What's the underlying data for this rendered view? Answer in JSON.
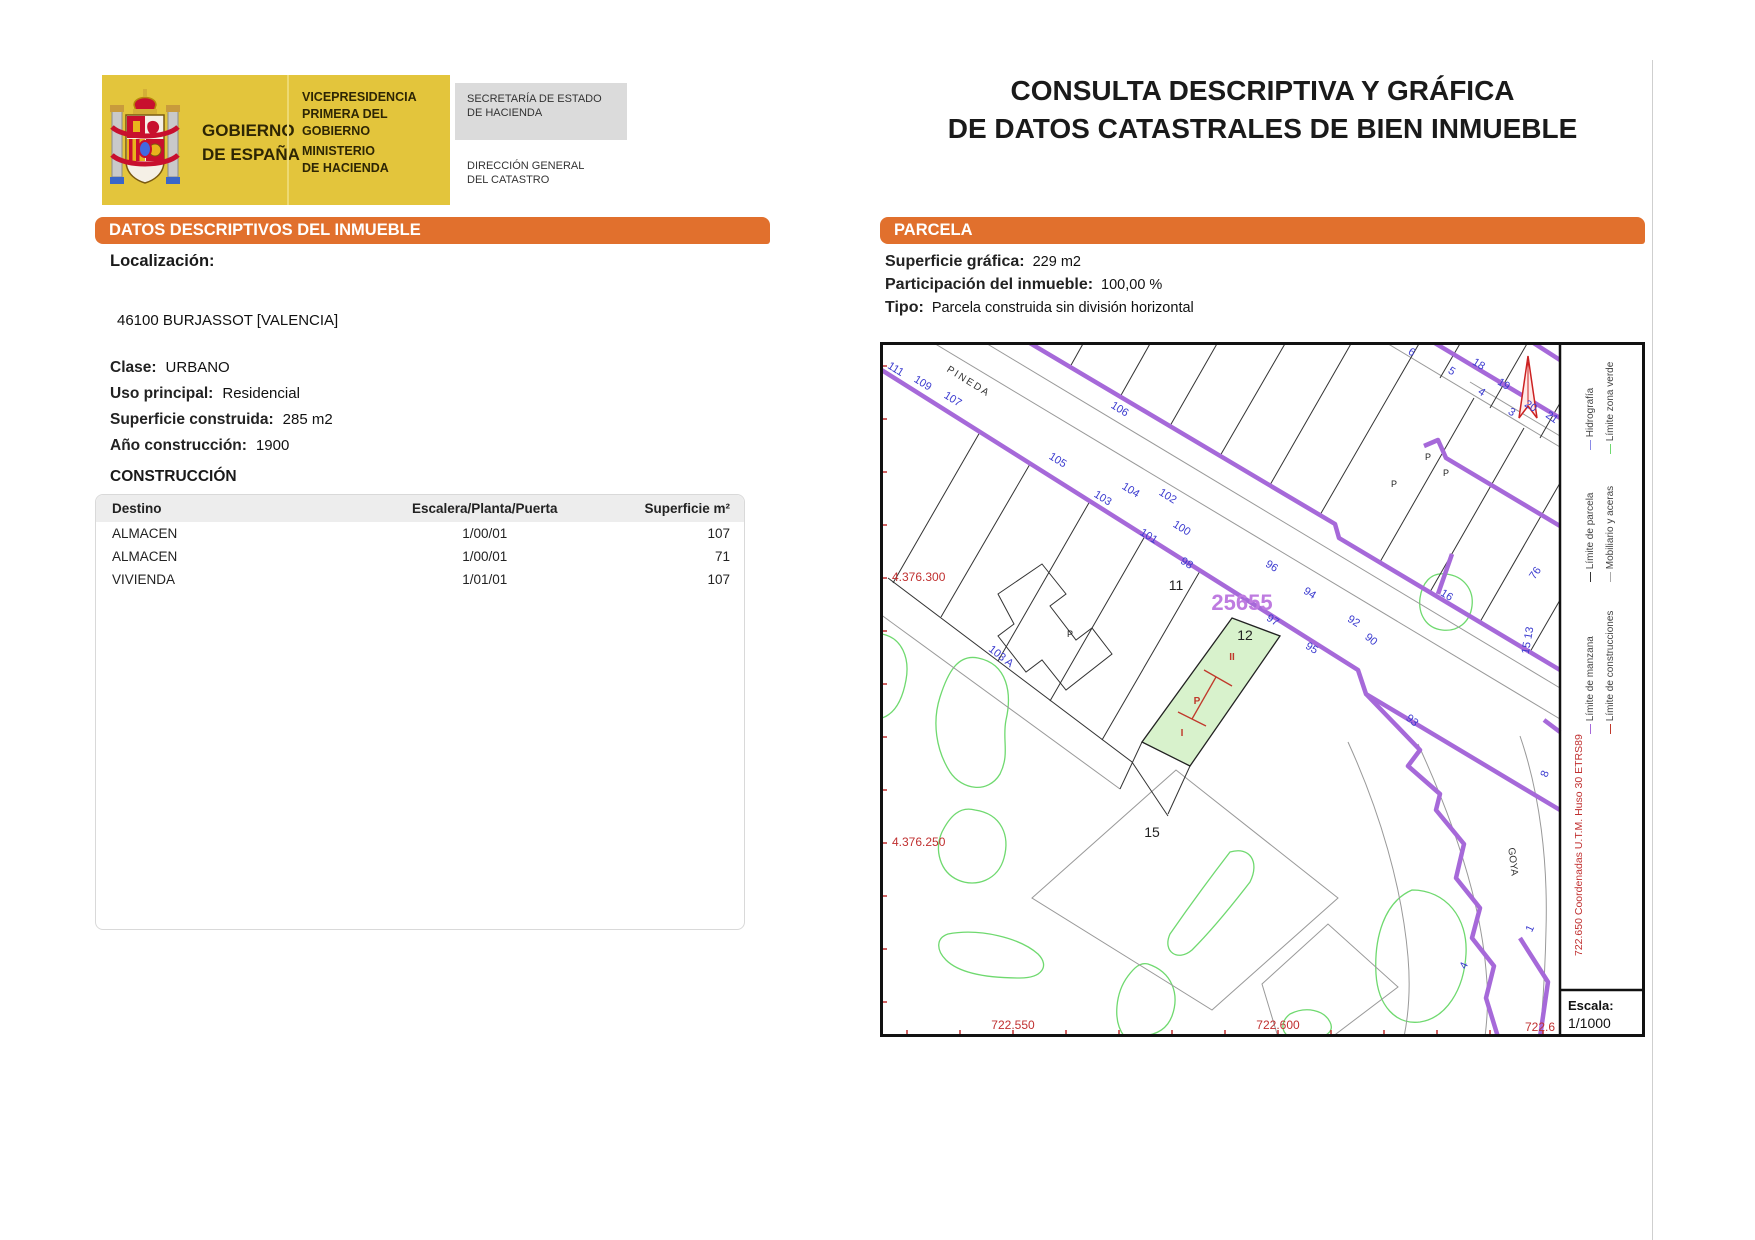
{
  "title": {
    "line1": "CONSULTA DESCRIPTIVA Y GRÁFICA",
    "line2": "DE DATOS CATASTRALES DE BIEN INMUEBLE"
  },
  "logo": {
    "gov_line1": "GOBIERNO",
    "gov_line2": "DE ESPAÑA",
    "vice_line1": "VICEPRESIDENCIA",
    "vice_line2": "PRIMERA DEL GOBIERNO",
    "min_line1": "MINISTERIO",
    "min_line2": "DE HACIENDA",
    "sec_line1": "SECRETARÍA DE ESTADO",
    "sec_line2": "DE HACIENDA",
    "dir_line1": "DIRECCIÓN GENERAL",
    "dir_line2": "DEL CATASTRO"
  },
  "descriptive": {
    "header": "DATOS DESCRIPTIVOS DEL INMUEBLE",
    "localizacion_label": "Localización:",
    "address": "46100 BURJASSOT [VALENCIA]",
    "fields": [
      {
        "label": "Clase:",
        "value": "URBANO"
      },
      {
        "label": "Uso principal:",
        "value": "Residencial"
      },
      {
        "label": "Superficie construida:",
        "value": "285 m2"
      },
      {
        "label": "Año construcción:",
        "value": "1900"
      }
    ],
    "construction": {
      "title": "CONSTRUCCIÓN",
      "columns": [
        "Destino",
        "Escalera/Planta/Puerta",
        "Superficie m²"
      ],
      "rows": [
        [
          "ALMACEN",
          "1/00/01",
          "107"
        ],
        [
          "ALMACEN",
          "1/00/01",
          "71"
        ],
        [
          "VIVIENDA",
          "1/01/01",
          "107"
        ]
      ]
    }
  },
  "parcel": {
    "header": "PARCELA",
    "fields": [
      {
        "label": "Superficie gráfica:",
        "value": "229 m2"
      },
      {
        "label": "Participación del inmueble:",
        "value": "100,00 %"
      },
      {
        "label": "Tipo:",
        "value": "Parcela construida sin división horizontal"
      }
    ]
  },
  "map": {
    "parcel_ref": "25655",
    "labels": [
      {
        "t": "PINEDA",
        "x": 87,
        "y": 42,
        "r": 32,
        "c": "#333333",
        "s": 10,
        "sp": 2
      },
      {
        "t": "111",
        "x": 14,
        "y": 30,
        "r": 32
      },
      {
        "t": "109",
        "x": 41,
        "y": 44,
        "r": 32
      },
      {
        "t": "107",
        "x": 71,
        "y": 60,
        "r": 32
      },
      {
        "t": "106",
        "x": 238,
        "y": 70,
        "r": 32
      },
      {
        "t": "105",
        "x": 176,
        "y": 121,
        "r": 32
      },
      {
        "t": "104",
        "x": 249,
        "y": 151,
        "r": 32
      },
      {
        "t": "103",
        "x": 221,
        "y": 159,
        "r": 32
      },
      {
        "t": "102",
        "x": 286,
        "y": 157,
        "r": 32
      },
      {
        "t": "101",
        "x": 267,
        "y": 197,
        "r": 32
      },
      {
        "t": "100",
        "x": 300,
        "y": 189,
        "r": 32
      },
      {
        "t": "98",
        "x": 305,
        "y": 224,
        "r": 32
      },
      {
        "t": "96",
        "x": 390,
        "y": 227,
        "r": 32
      },
      {
        "t": "97",
        "x": 391,
        "y": 281,
        "r": 32
      },
      {
        "t": "94",
        "x": 428,
        "y": 254,
        "r": 32
      },
      {
        "t": "95",
        "x": 430,
        "y": 309,
        "r": 32
      },
      {
        "t": "92",
        "x": 472,
        "y": 282,
        "r": 32
      },
      {
        "t": "90",
        "x": 489,
        "y": 300,
        "r": 40
      },
      {
        "t": "93",
        "x": 530,
        "y": 381,
        "r": 40
      },
      {
        "t": "103 A",
        "x": 119,
        "y": 317,
        "r": 38
      },
      {
        "t": "6",
        "x": 530,
        "y": 13,
        "r": 32
      },
      {
        "t": "5",
        "x": 570,
        "y": 32,
        "r": 32
      },
      {
        "t": "4",
        "x": 600,
        "y": 53,
        "r": 32
      },
      {
        "t": "3",
        "x": 630,
        "y": 73,
        "r": 32
      },
      {
        "t": "18",
        "x": 597,
        "y": 25,
        "r": 32
      },
      {
        "t": "19",
        "x": 622,
        "y": 45,
        "r": 32
      },
      {
        "t": "20",
        "x": 649,
        "y": 67,
        "r": 32
      },
      {
        "t": "21",
        "x": 670,
        "y": 78,
        "r": 35
      },
      {
        "t": "16",
        "x": 565,
        "y": 256,
        "r": 32
      },
      {
        "t": "76",
        "x": 658,
        "y": 233,
        "r": -55
      },
      {
        "t": "15 13",
        "x": 651,
        "y": 299,
        "r": -80
      },
      {
        "t": "8",
        "x": 668,
        "y": 433,
        "r": -70
      },
      {
        "t": "1",
        "x": 653,
        "y": 588,
        "r": -65
      },
      {
        "t": "4",
        "x": 587,
        "y": 625,
        "r": -65
      },
      {
        "t": "11",
        "x": 296,
        "y": 248,
        "r": 0,
        "c": "#222222",
        "s": 14
      },
      {
        "t": "12",
        "x": 365,
        "y": 298,
        "r": 0,
        "c": "#222222",
        "s": 14
      },
      {
        "t": "15",
        "x": 272,
        "y": 495,
        "r": 0,
        "c": "#222222",
        "s": 14
      },
      {
        "t": "P",
        "x": 548,
        "y": 118,
        "r": 0,
        "c": "#222222",
        "s": 9
      },
      {
        "t": "P",
        "x": 566,
        "y": 134,
        "r": 0,
        "c": "#222222",
        "s": 9
      },
      {
        "t": "P",
        "x": 514,
        "y": 145,
        "r": 0,
        "c": "#222222",
        "s": 9
      },
      {
        "t": "P",
        "x": 190,
        "y": 295,
        "r": 0,
        "c": "#222222",
        "s": 9
      },
      {
        "t": "GOYA",
        "x": 630,
        "y": 520,
        "r": 83,
        "c": "#333333",
        "s": 10
      },
      {
        "t": "25655",
        "x": 362,
        "y": 268,
        "r": 0,
        "c": "#BE7BE0",
        "s": 22,
        "b": 1
      },
      {
        "t": "II",
        "x": 352,
        "y": 318,
        "r": 0,
        "c": "#C0392B",
        "s": 10,
        "b": 1
      },
      {
        "t": "P",
        "x": 317,
        "y": 362,
        "r": 0,
        "c": "#C0392B",
        "s": 10,
        "b": 1
      },
      {
        "t": "I",
        "x": 302,
        "y": 394,
        "r": 0,
        "c": "#C0392B",
        "s": 10,
        "b": 1
      },
      {
        "t": "4.376.300",
        "x": 12,
        "y": 239,
        "r": 0,
        "c": "#C03030",
        "s": 12,
        "a": "start"
      },
      {
        "t": "4.376.250",
        "x": 12,
        "y": 504,
        "r": 0,
        "c": "#C03030",
        "s": 12,
        "a": "start"
      },
      {
        "t": "722.550",
        "x": 133,
        "y": 687,
        "r": 0,
        "c": "#C03030",
        "s": 12
      },
      {
        "t": "722.600",
        "x": 398,
        "y": 687,
        "r": 0,
        "c": "#C03030",
        "s": 12
      },
      {
        "t": "722.6",
        "x": 660,
        "y": 689,
        "r": 0,
        "c": "#C03030",
        "s": 12
      }
    ],
    "legend": {
      "entries": [
        {
          "label": "Hidrografía",
          "color": "#8A8AE6",
          "x": 713,
          "y": 108
        },
        {
          "label": "Límite zona verde",
          "color": "#6FD96F",
          "x": 733,
          "y": 112
        },
        {
          "label": "Límite de parcela",
          "color": "#333333",
          "x": 713,
          "y": 240
        },
        {
          "label": "Mobiliario y aceras",
          "color": "#AAAAAA",
          "x": 733,
          "y": 240
        },
        {
          "label": "Límite de manzana",
          "color": "#A669D9",
          "x": 713,
          "y": 392
        },
        {
          "label": "Límite de construcciones",
          "color": "#C0392B",
          "x": 733,
          "y": 392
        }
      ],
      "coords_note": "722.650 Coordenadas U.T.M. Huso 30 ETRS89",
      "scale_label": "Escala:",
      "scale_value": "1/1000"
    }
  },
  "colors": {
    "accent_orange": "#E1702D",
    "logo_yellow": "#E3C53C",
    "map_purple": "#A669D9",
    "map_blue": "#3A3ACF",
    "map_red": "#C03030",
    "map_green": "#6FD96F",
    "subject_parcel_fill": "#D8F2CC"
  }
}
